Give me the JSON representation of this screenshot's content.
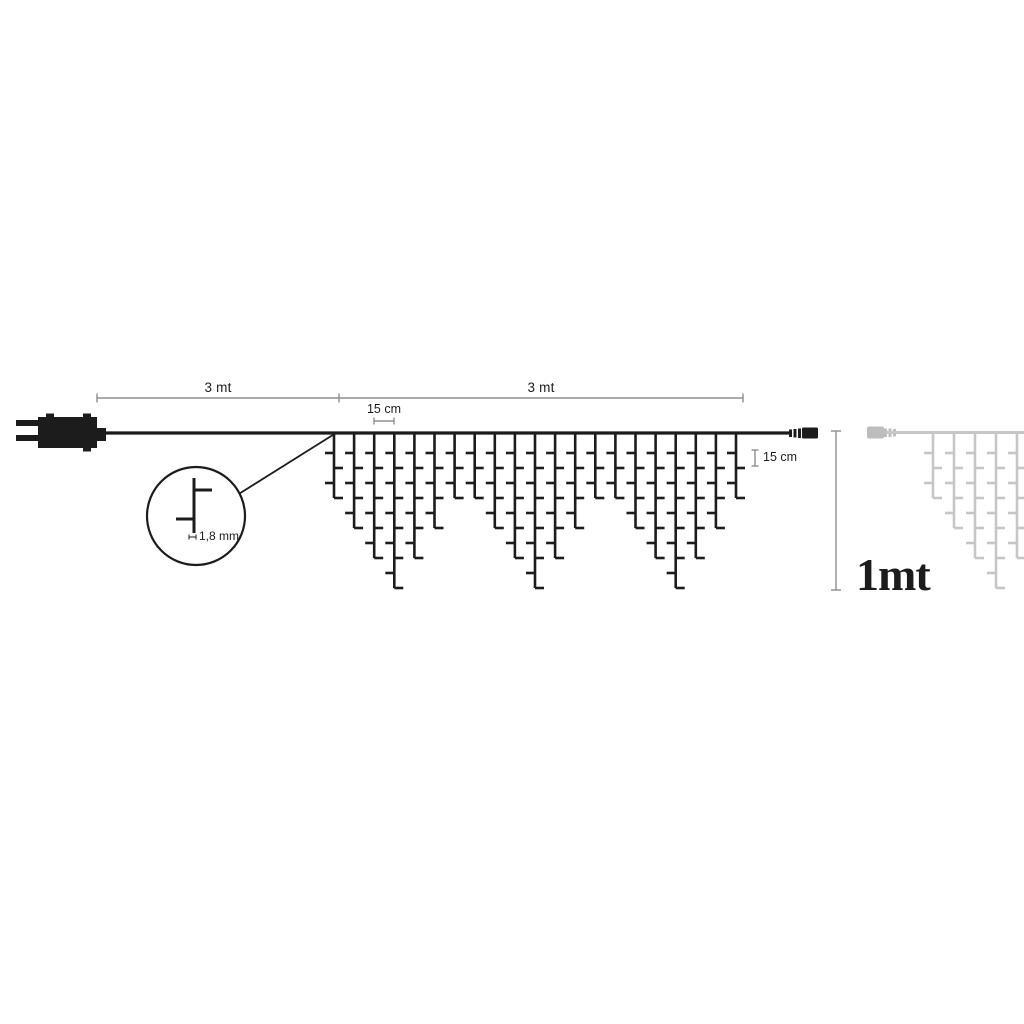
{
  "labels": {
    "lead_length": "3 mt",
    "run_length": "3 mt",
    "horizontal_spacing": "15 cm",
    "vertical_spacing": "15 cm",
    "wire_diameter": "1,8 mm",
    "height": "1mt"
  },
  "diagram": {
    "colors": {
      "ink": "#1c1c1c",
      "dim_line": "#8f8f8f",
      "ghost": "#c6c6c6",
      "ghost_connector": "#bdbdbd",
      "background": "#ffffff"
    },
    "curtain": {
      "wire_y": 433,
      "level_px": 15,
      "first_drop_px": 20,
      "tick_px": 9,
      "stroke_px": 2.6,
      "strand_depth_pattern": [
        4,
        6,
        8,
        10,
        8,
        6,
        4
      ],
      "repeats": 3,
      "black": {
        "start_x": 334,
        "spacing_px": 20.1,
        "color": "#1c1c1c"
      },
      "gray": {
        "start_x": 933,
        "spacing_px": 21,
        "depths": [
          4,
          6,
          8,
          10,
          8
        ],
        "color": "#c6c6c6"
      }
    }
  }
}
